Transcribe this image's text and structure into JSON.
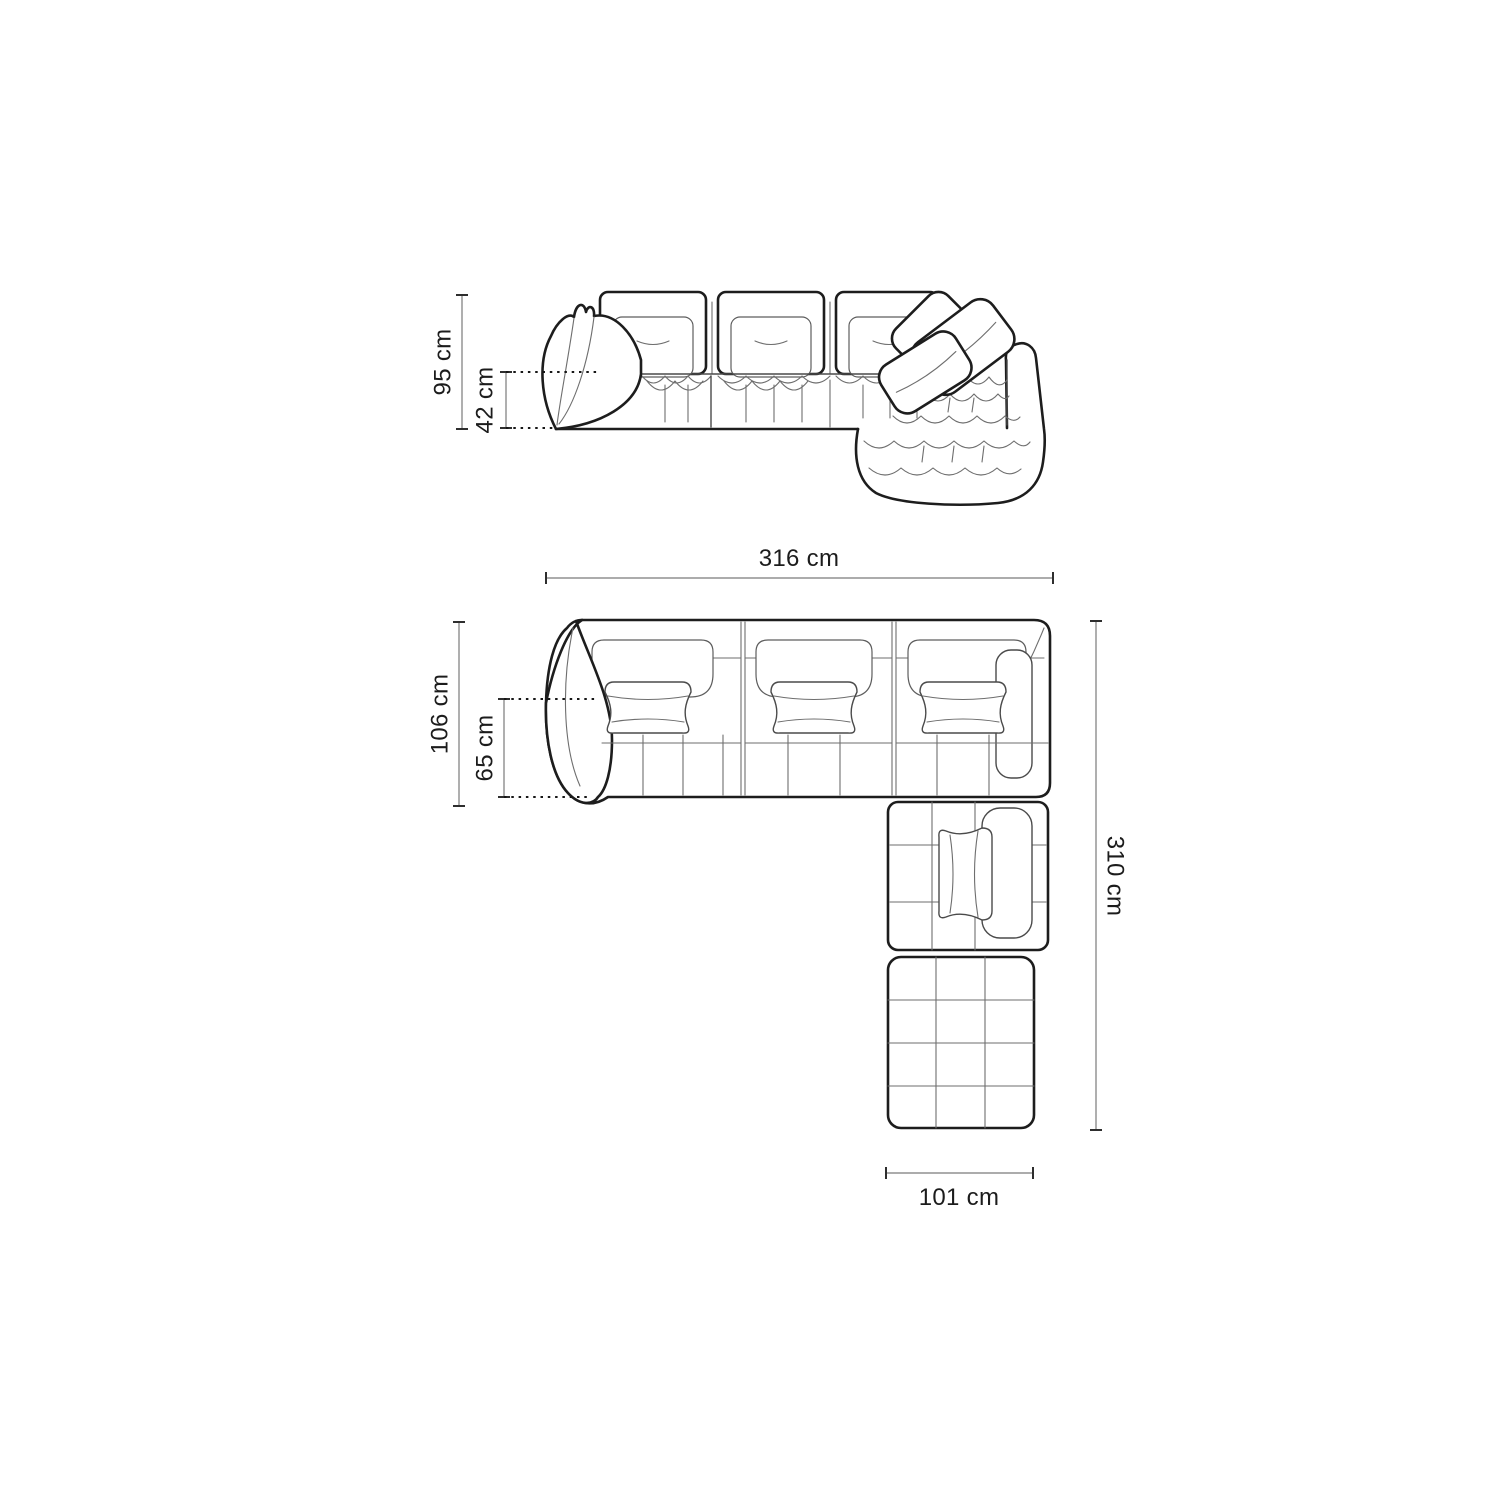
{
  "labels": {
    "front_height": "95 cm",
    "front_seat_height": "42 cm",
    "plan_width": "316 cm",
    "plan_depth": "106 cm",
    "plan_seat_depth": "65 cm",
    "plan_total_depth": "310 cm",
    "plan_chaise_width": "101 cm"
  },
  "dimensions": [
    {
      "id": "overall-height",
      "value": 95,
      "unit": "cm",
      "label": "95 cm",
      "view": "front"
    },
    {
      "id": "seat-height",
      "value": 42,
      "unit": "cm",
      "label": "42 cm",
      "view": "front"
    },
    {
      "id": "overall-width",
      "value": 316,
      "unit": "cm",
      "label": "316 cm",
      "view": "plan"
    },
    {
      "id": "body-depth",
      "value": 106,
      "unit": "cm",
      "label": "106 cm",
      "view": "plan"
    },
    {
      "id": "seat-depth",
      "value": 65,
      "unit": "cm",
      "label": "65 cm",
      "view": "plan"
    },
    {
      "id": "overall-depth",
      "value": 310,
      "unit": "cm",
      "label": "310 cm",
      "view": "plan"
    },
    {
      "id": "chaise-width",
      "value": 101,
      "unit": "cm",
      "label": "101 cm",
      "view": "plan"
    }
  ],
  "colors": {
    "background": "#ffffff",
    "outline": "#1d1d1d",
    "thin_line": "#6e6e6e",
    "dimension_line": "#7a7a7a",
    "dotted_line": "#161616",
    "text": "#1c1c1c"
  }
}
